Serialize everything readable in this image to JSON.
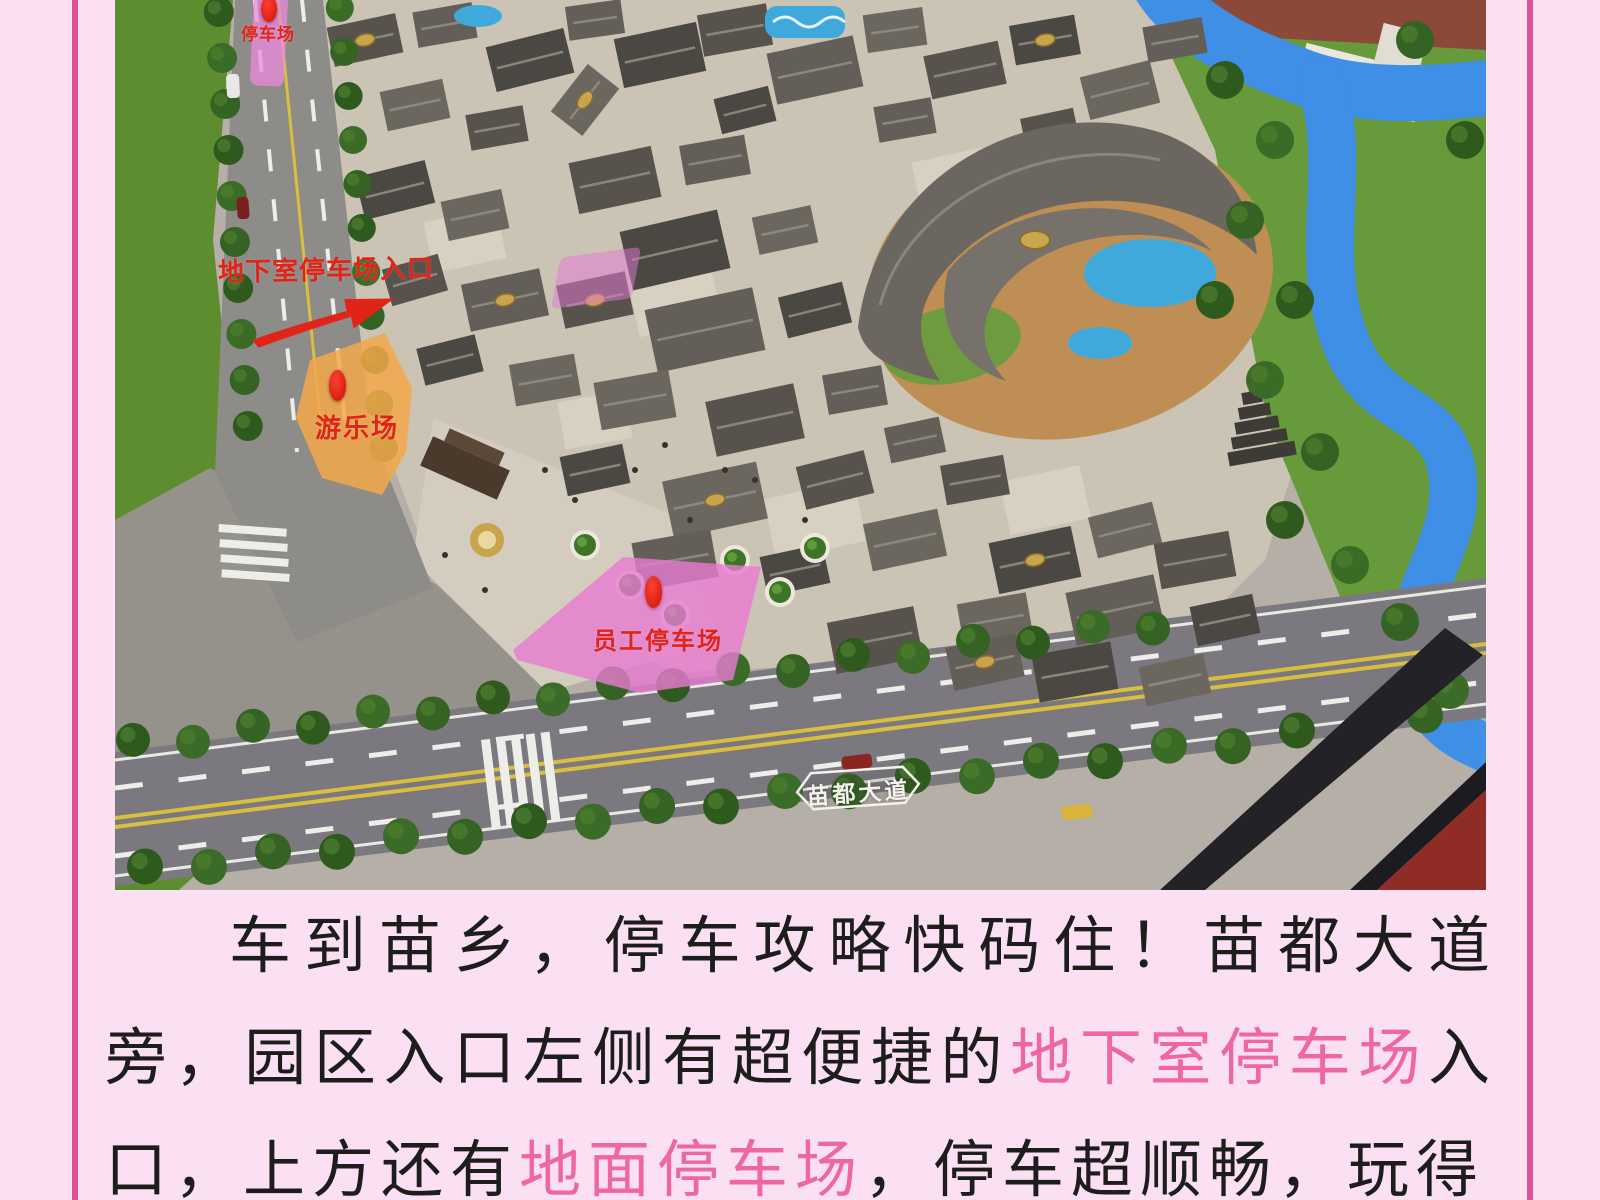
{
  "photo": {
    "road_label": "苗都大道",
    "annotations": {
      "ground_parking": "停车场",
      "underground_entrance": "地下室停车场入口",
      "playground": "游乐场",
      "employee_parking": "员工停车场"
    }
  },
  "caption": {
    "segments": [
      {
        "text": "车到苗乡，停车攻略快码住！苗都大道旁，园区入口左侧有超便捷的",
        "highlight": false
      },
      {
        "text": "地下室停车场",
        "highlight": true
      },
      {
        "text": "入口，上方还有",
        "highlight": false
      },
      {
        "text": "地面停车场",
        "highlight": true
      },
      {
        "text": "，停车超顺畅，玩得",
        "highlight": false
      }
    ]
  },
  "colors": {
    "page_background": "#FAE0F2",
    "border_line": "#DC5296",
    "caption_text": "#1D1D1D",
    "caption_highlight": "#EE67A3",
    "annotation_red": "#E02418",
    "playground_zone": "#F2A94F",
    "parking_zone_pink": "#E879D2",
    "river_blue": "#3E8FE5"
  }
}
